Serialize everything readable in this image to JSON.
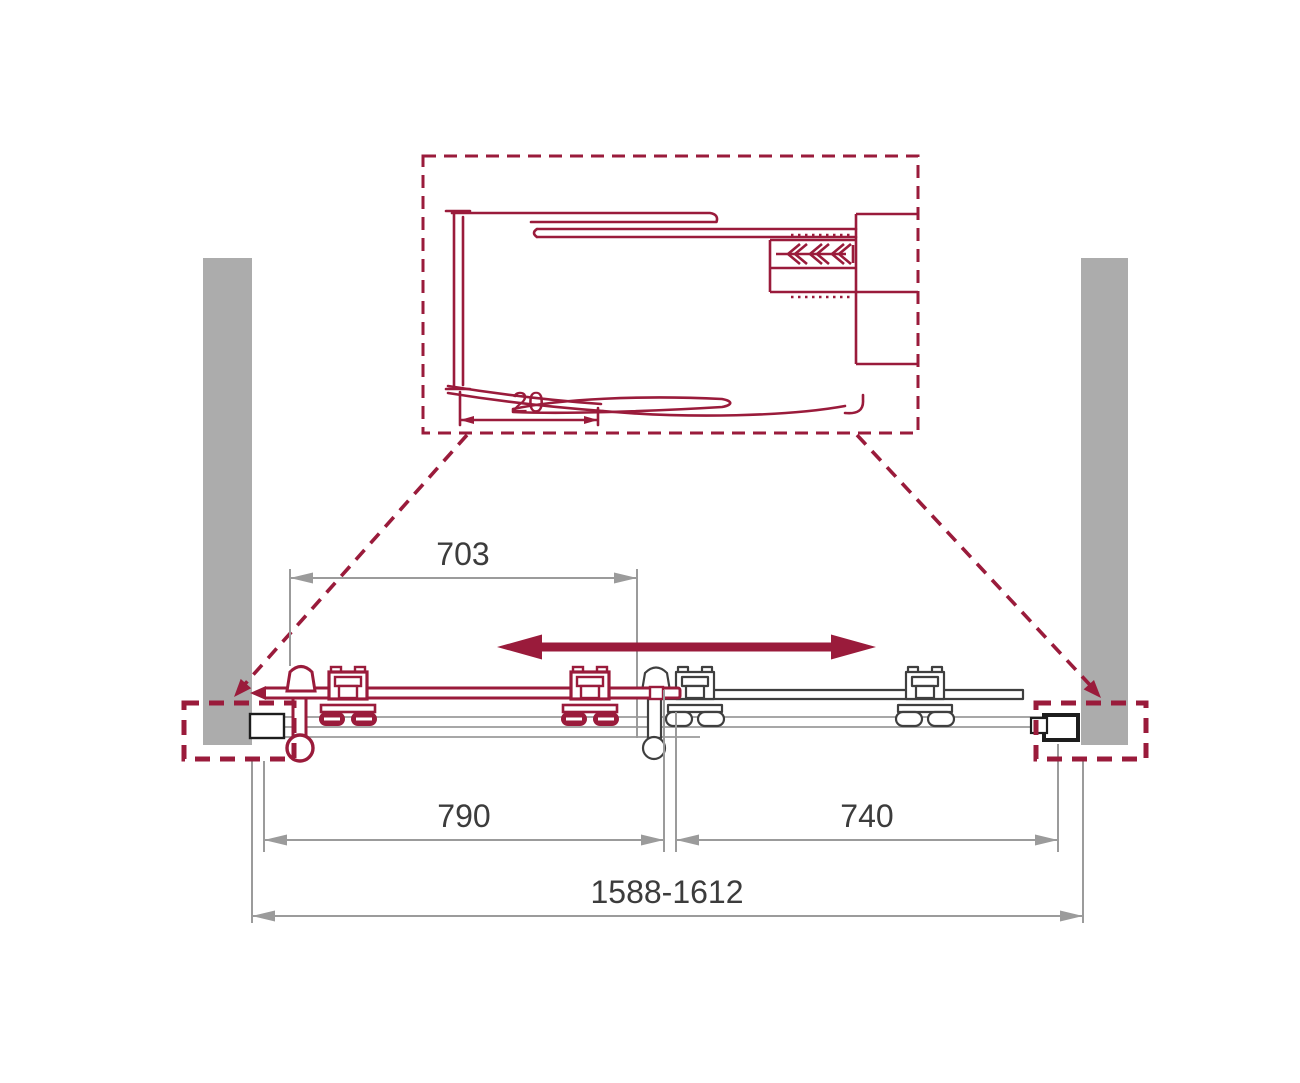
{
  "detail_view": {
    "gap_dimension_label": "20"
  },
  "dimensions": {
    "door_opening_top": "703",
    "sliding_door_width": "790",
    "fixed_panel_width": "740",
    "overall_width_range": "1588-1612"
  },
  "colors": {
    "accent": "#9A1B3B",
    "wall": "#ACACAC",
    "dim_line": "#9B9B9B",
    "dim_text": "#3C3C3C",
    "fixed_outline": "#3F3F3F",
    "profile_outline": "#1D1D1D",
    "background": "#FFFFFF"
  }
}
